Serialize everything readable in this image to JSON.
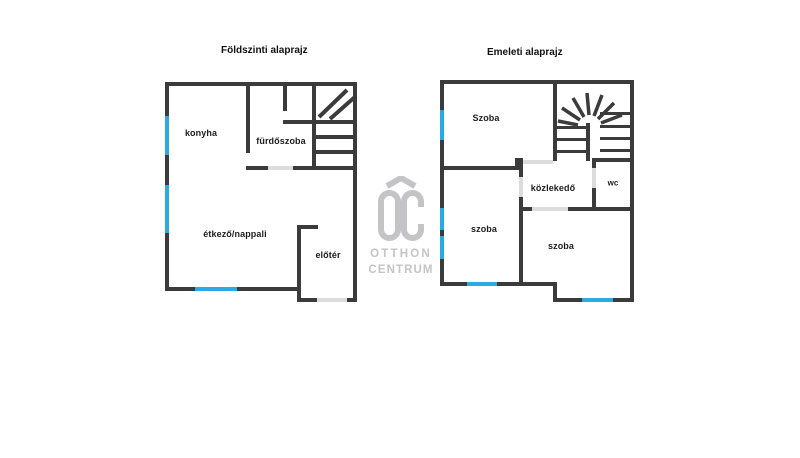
{
  "plans": {
    "ground": {
      "title": "Földszinti alaprajz",
      "rooms": {
        "konyha": "konyha",
        "furdoszoba": "fürdőszoba",
        "etkezo": "étkező/nappali",
        "eloter": "előtér"
      }
    },
    "upper": {
      "title": "Emeleti alaprajz",
      "rooms": {
        "szoba_top": "Szoba",
        "szoba_left": "szoba",
        "szoba_bottom": "szoba",
        "kozlekedo": "közlekedő",
        "wc": "wc"
      }
    }
  },
  "logo": {
    "monogram": "OC",
    "line1": "OTTHON",
    "line2": "CENTRUM"
  },
  "colors": {
    "wall": "#3b3b3b",
    "window": "#29abe2",
    "door": "#dcdcdc",
    "logo": "#c4c4c7",
    "label": "#1d1d1d"
  }
}
